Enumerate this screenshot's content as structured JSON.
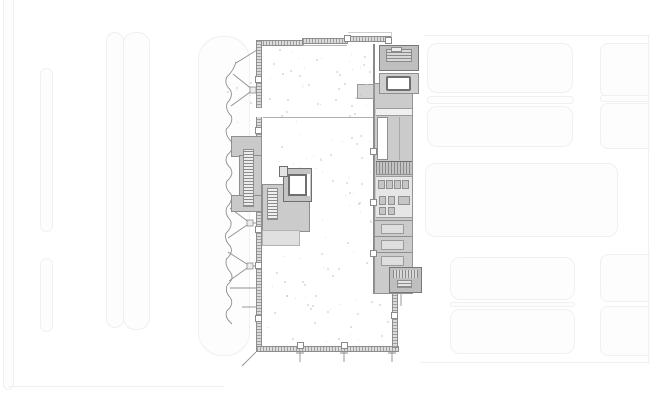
{
  "meta": {
    "title": "Architectural ground-floor plan drawing with faint site context",
    "type": "floor-plan",
    "visible_text": "none"
  },
  "palette": {
    "background": "#ffffff",
    "context_border": "#f0f0f0",
    "context_fill": "#fdfdfd",
    "wall": "#8d8d8d",
    "room_gray": "#cbcbcb",
    "room_dark": "#bfbfbf",
    "room_light": "#e6e6e6",
    "line": "#8f8f8f",
    "speckle": "#c9c9c9"
  },
  "context": {
    "left_lanes": [
      {
        "n": "context-lane",
        "x": 3,
        "y": -28,
        "w": 11,
        "h": 418,
        "r": 6
      },
      {
        "n": "context-lane",
        "x": 40,
        "y": 68,
        "w": 13,
        "h": 164,
        "r": 7
      },
      {
        "n": "context-lane",
        "x": 40,
        "y": 258,
        "w": 13,
        "h": 74,
        "r": 7
      },
      {
        "n": "context-lane",
        "x": 106,
        "y": 32,
        "w": 18,
        "h": 296,
        "r": 9
      },
      {
        "n": "context-lane",
        "x": 123,
        "y": 32,
        "w": 27,
        "h": 298,
        "r": 12
      },
      {
        "n": "context-lane",
        "x": 198,
        "y": 36,
        "w": 52,
        "h": 320,
        "r": 24
      }
    ],
    "right_blocks": [
      {
        "n": "context-block",
        "x": 427,
        "y": 43,
        "w": 146,
        "h": 50,
        "r": 10
      },
      {
        "n": "context-block",
        "x": 600,
        "y": 43,
        "w": 54,
        "h": 54,
        "r": 8
      },
      {
        "n": "context-band",
        "x": 427,
        "y": 96,
        "w": 147,
        "h": 8,
        "r": 4
      },
      {
        "n": "context-band",
        "x": 600,
        "y": 95,
        "w": 54,
        "h": 7,
        "r": 3
      },
      {
        "n": "context-block",
        "x": 427,
        "y": 106,
        "w": 146,
        "h": 41,
        "r": 10
      },
      {
        "n": "context-block",
        "x": 600,
        "y": 103,
        "w": 54,
        "h": 46,
        "r": 8
      },
      {
        "n": "context-block",
        "x": 425,
        "y": 163,
        "w": 193,
        "h": 74,
        "r": 10
      },
      {
        "n": "context-block",
        "x": 450,
        "y": 257,
        "w": 125,
        "h": 43,
        "r": 10
      },
      {
        "n": "context-block",
        "x": 600,
        "y": 254,
        "w": 54,
        "h": 48,
        "r": 8
      },
      {
        "n": "context-band",
        "x": 450,
        "y": 302,
        "w": 125,
        "h": 5,
        "r": 3
      },
      {
        "n": "context-block",
        "x": 450,
        "y": 309,
        "w": 125,
        "h": 45,
        "r": 10
      },
      {
        "n": "context-block",
        "x": 600,
        "y": 306,
        "w": 54,
        "h": 50,
        "r": 8
      }
    ],
    "lines": [
      {
        "n": "context-street-line",
        "x": 8,
        "y": 386,
        "w": 217,
        "h": 1
      },
      {
        "n": "context-street-line",
        "x": 424,
        "y": 35,
        "w": 226,
        "h": 1
      },
      {
        "n": "context-street-line",
        "x": 420,
        "y": 362,
        "w": 230,
        "h": 1
      },
      {
        "n": "context-street-line",
        "x": 648,
        "y": 35,
        "w": 1,
        "h": 328
      }
    ]
  },
  "pilasters": [
    {
      "x": 255,
      "y": 76
    },
    {
      "x": 255,
      "y": 127
    },
    {
      "x": 255,
      "y": 226
    },
    {
      "x": 255,
      "y": 262
    },
    {
      "x": 255,
      "y": 315
    },
    {
      "x": 370,
      "y": 148
    },
    {
      "x": 370,
      "y": 199
    },
    {
      "x": 370,
      "y": 250
    },
    {
      "x": 297,
      "y": 342
    },
    {
      "x": 341,
      "y": 342
    },
    {
      "x": 344,
      "y": 35
    },
    {
      "x": 385,
      "y": 37
    },
    {
      "x": 391,
      "y": 312
    }
  ],
  "fixtures": [
    {
      "x": 378,
      "y": 180,
      "w": 7,
      "h": 9
    },
    {
      "x": 386,
      "y": 180,
      "w": 7,
      "h": 9
    },
    {
      "x": 394,
      "y": 180,
      "w": 7,
      "h": 9
    },
    {
      "x": 402,
      "y": 180,
      "w": 7,
      "h": 9
    },
    {
      "x": 379,
      "y": 196,
      "w": 7,
      "h": 9
    },
    {
      "x": 388,
      "y": 196,
      "w": 7,
      "h": 9
    },
    {
      "x": 398,
      "y": 196,
      "w": 12,
      "h": 9
    },
    {
      "x": 379,
      "y": 207,
      "w": 7,
      "h": 8
    },
    {
      "x": 388,
      "y": 207,
      "w": 7,
      "h": 8
    }
  ],
  "stalls": [
    220,
    236,
    252
  ],
  "speckles": {
    "seed": 9,
    "size": 2,
    "regions": [
      {
        "x": 264,
        "w": 106,
        "y": 47,
        "h": 68,
        "count": 42
      },
      {
        "x": 264,
        "w": 106,
        "y": 120,
        "h": 60,
        "count": 24
      },
      {
        "x": 264,
        "w": 124,
        "y": 234,
        "h": 108,
        "count": 44
      },
      {
        "x": 314,
        "w": 56,
        "y": 182,
        "h": 50,
        "count": 12
      },
      {
        "x": 226,
        "w": 28,
        "y": 64,
        "h": 68,
        "count": 8
      }
    ]
  },
  "canopy_wave": {
    "x_base": 229,
    "y_top": 64,
    "y_bottom": 330,
    "step": 13,
    "amp": 4,
    "start_x": 236,
    "start_y": 62
  }
}
